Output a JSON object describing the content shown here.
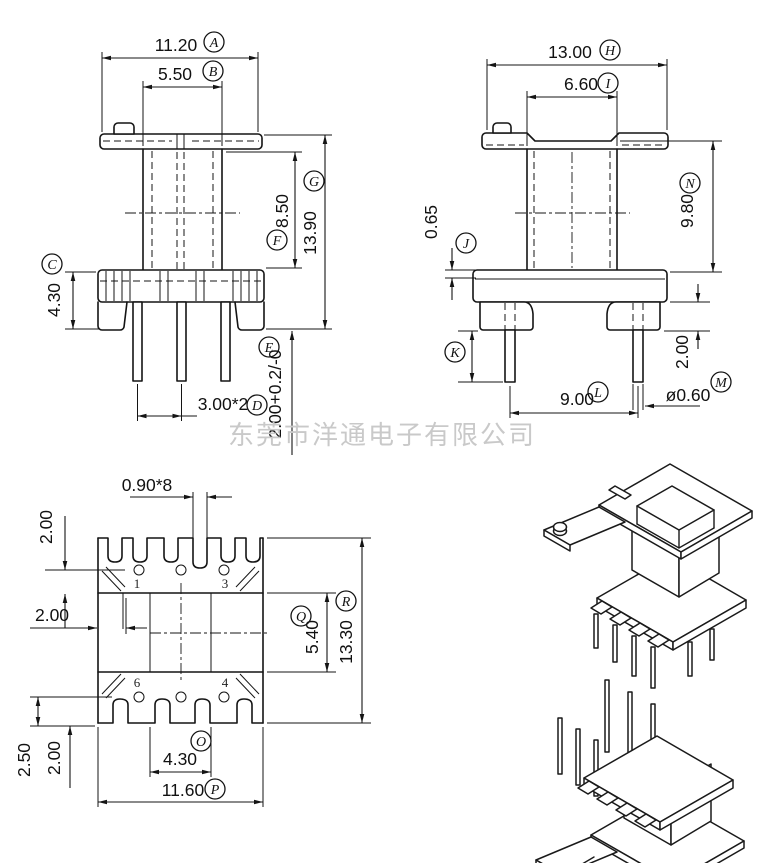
{
  "watermark": "东莞市洋通电子有限公司",
  "pins": {
    "p1": "1",
    "p3": "3",
    "p6": "6",
    "p4": "4"
  },
  "dims": {
    "a": {
      "label": "A",
      "value": "11.20"
    },
    "b": {
      "label": "B",
      "value": "5.50"
    },
    "c": {
      "label": "C",
      "value": "4.30"
    },
    "d": {
      "label": "D",
      "value": "3.00*2"
    },
    "e": {
      "label": "E",
      "value": "2.00+0.2/-0"
    },
    "f": {
      "label": "F",
      "value": "8.50"
    },
    "g": {
      "label": "G",
      "value": "13.90"
    },
    "h": {
      "label": "H",
      "value": "13.00"
    },
    "i": {
      "label": "I",
      "value": "6.60"
    },
    "j": {
      "label": "J",
      "value": "0.65"
    },
    "k": {
      "label": "K"
    },
    "l": {
      "label": "L",
      "value": "9.00"
    },
    "m": {
      "label": "M",
      "value": "ø0.60"
    },
    "n": {
      "label": "N",
      "value": "9.80"
    },
    "o": {
      "label": "O",
      "value": "4.30"
    },
    "p": {
      "label": "P",
      "value": "11.60"
    },
    "q": {
      "label": "Q",
      "value": "5.40"
    },
    "r": {
      "label": "R",
      "value": "13.30"
    }
  },
  "other": {
    "slot": "0.90*8",
    "plan_top_margin": "2.00",
    "plan_wall": "2.00",
    "side_leg_height": "2.00",
    "plan_bottom_offset": "2.50",
    "plan_bottom_margin": "2.00"
  }
}
